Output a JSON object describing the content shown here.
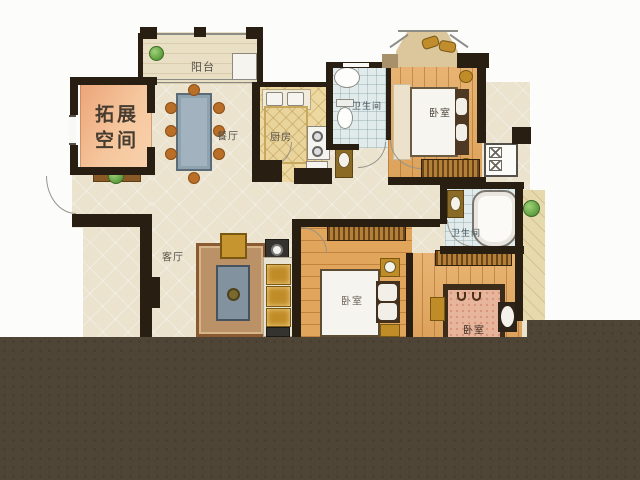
{
  "title": "apartment floor plan",
  "labels": {
    "expansion_line1": "拓展",
    "expansion_line2": "空间",
    "balcony": "阳台",
    "dining": "餐厅",
    "kitchen": "厨房",
    "bath_top": "卫生间",
    "bedroom_top_right": "卧室",
    "living": "客厅",
    "bath_mid": "卫生间",
    "bedroom_mid": "卧室",
    "bedroom_bottom_right": "卧室"
  },
  "colors": {
    "wall": "#281e12",
    "overlay": "#4f4537",
    "tile_floor": "#ebe3cd",
    "wood_floor": "#e5a95f",
    "kitchen_floor": "#ecd8a0",
    "bath_floor": "#e1ebec",
    "balcony_floor": "#e9dfc4",
    "expansion_gradient_from": "#eca478",
    "expansion_gradient_to": "#f8d2ae",
    "accent_gold": "#c08c28",
    "plant_green": "#6fae4e"
  }
}
